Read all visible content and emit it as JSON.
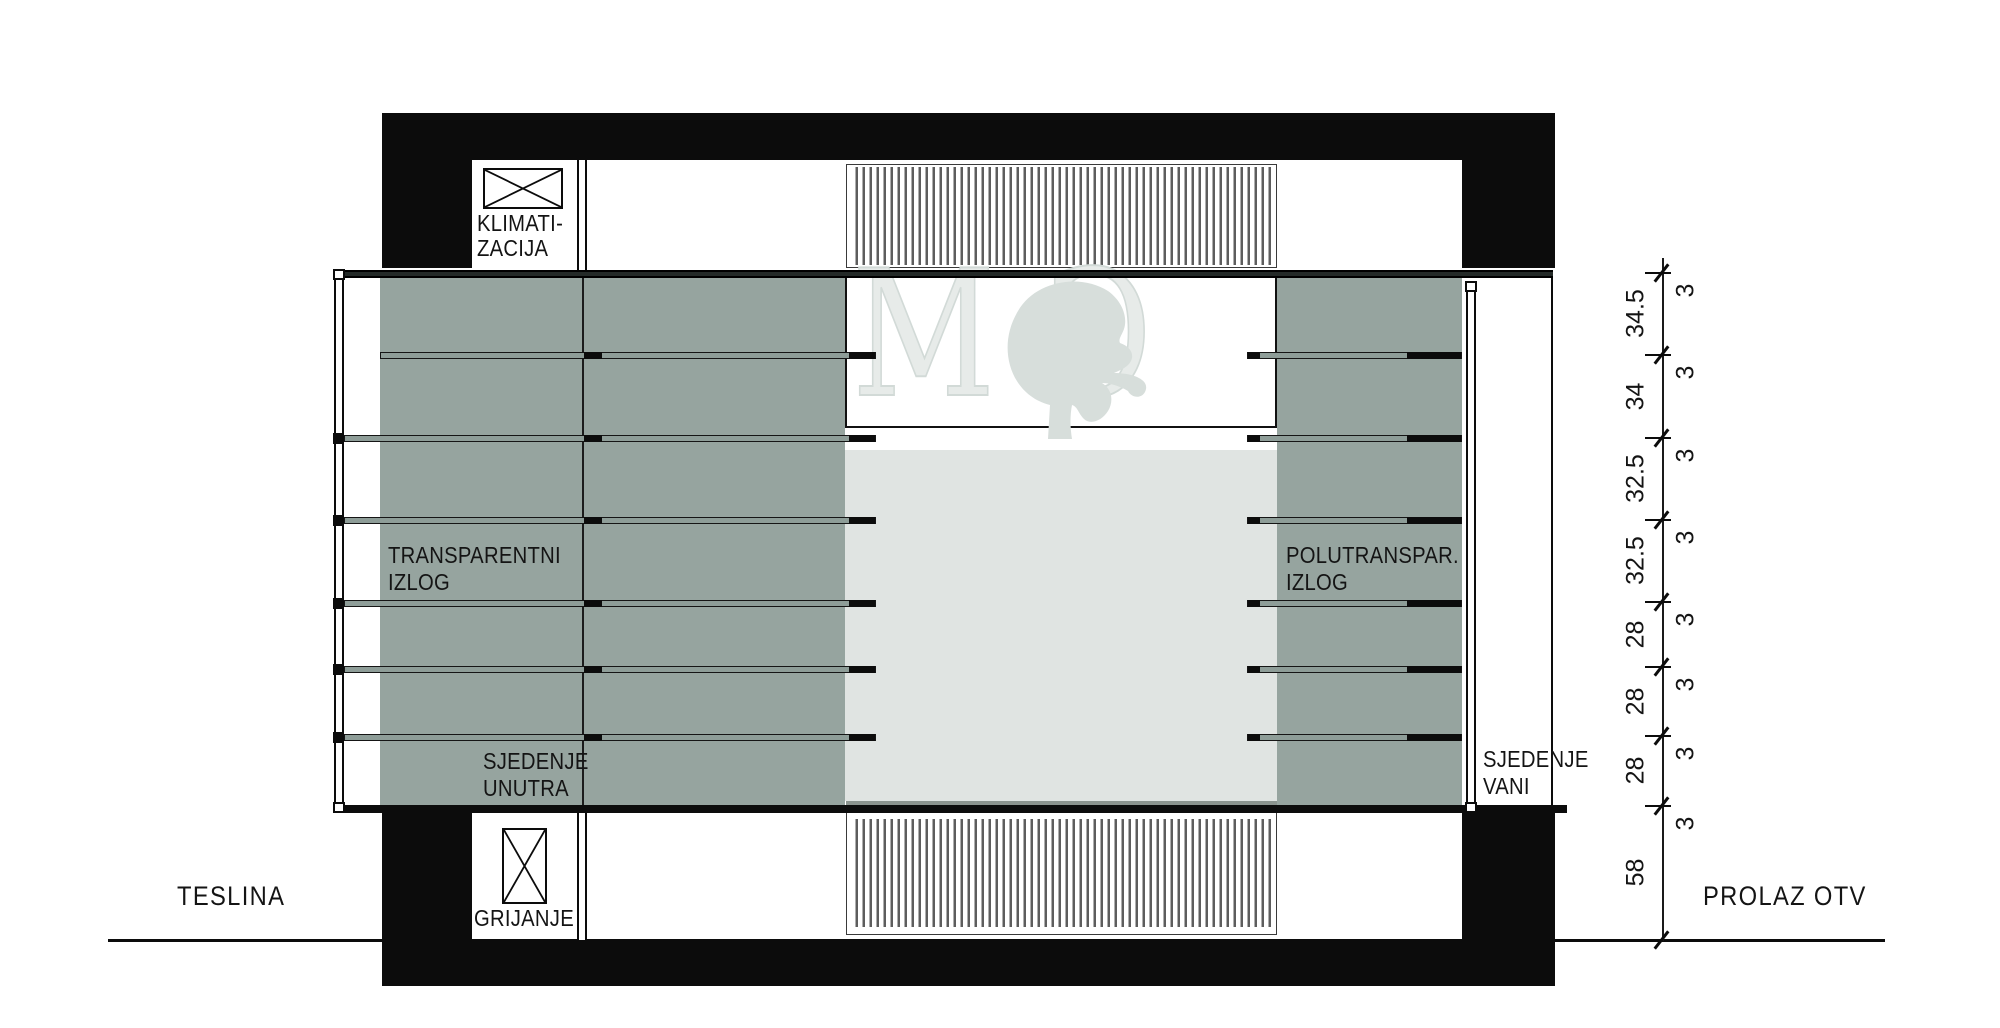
{
  "labels": {
    "klimatizacija": {
      "line1": "KLIMATI-",
      "line2": "ZACIJA"
    },
    "transparentni_izlog": {
      "line1": "TRANSPARENTNI",
      "line2": "IZLOG"
    },
    "polutransparentni_izlog": {
      "line1": "POLUTRANSPAR.",
      "line2": "IZLOG"
    },
    "sjedenje_unutra": {
      "line1": "SJEDENJE",
      "line2": "UNUTRA"
    },
    "sjedenje_vani": {
      "line1": "SJEDENJE",
      "line2": "VANI"
    },
    "grijanje": "GRIJANJE",
    "street_left": "TESLINA",
    "street_right": "PROLAZ OTV"
  },
  "watermark": {
    "letter_m": "M",
    "letter_g": "G"
  },
  "dimension_chain": {
    "gaps": [
      "34.5",
      "34",
      "32.5",
      "32.5",
      "28",
      "28",
      "28",
      "58"
    ],
    "bar_thickness": [
      "3",
      "3",
      "3",
      "3",
      "3",
      "3",
      "3",
      "3"
    ]
  },
  "colors": {
    "ink": "#0c0c0c",
    "panel_gray": "#96a49f",
    "interior_light": "#e0e4e2",
    "watermark_gray": "#d7dedb"
  }
}
